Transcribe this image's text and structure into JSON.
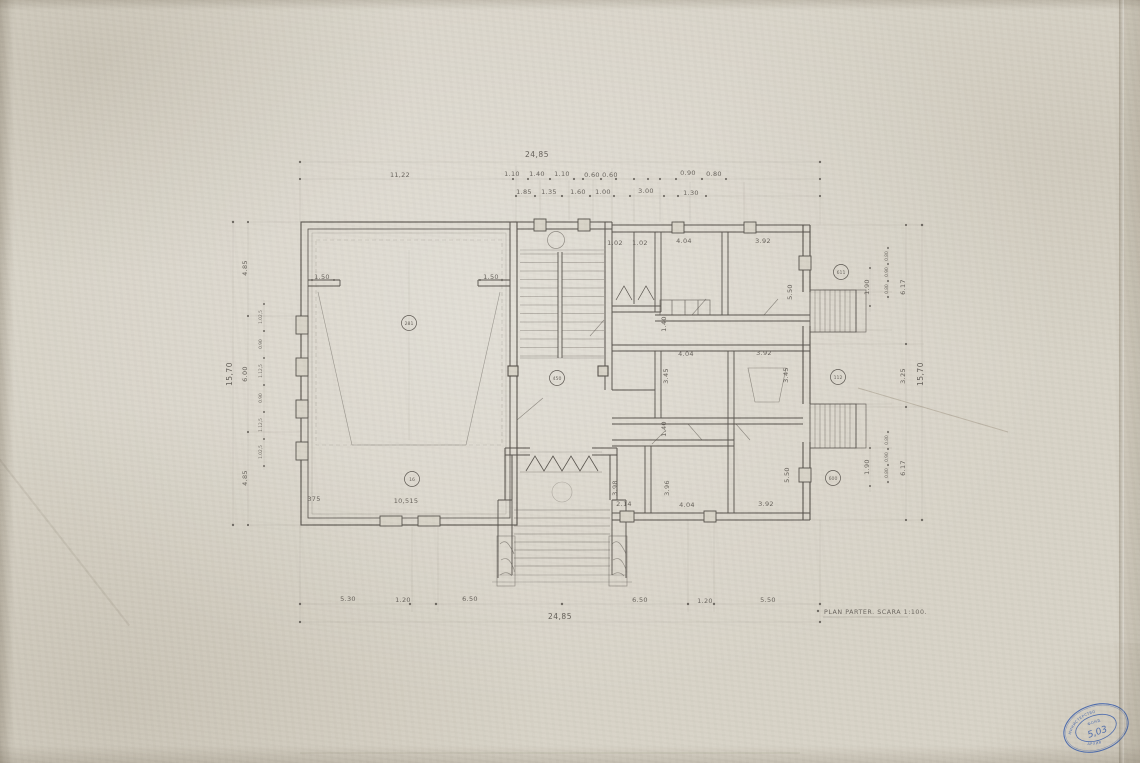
{
  "colors": {
    "paper": "#d8d3c7",
    "ink": "#56514b",
    "stamp": "#3d63b2"
  },
  "caption": "PLAN PARTER. SCARA 1:100.",
  "dims": {
    "top_total": "24,85",
    "top1": [
      "11,22",
      "1.10",
      "1.40",
      "1.10",
      "0.60",
      "0.60",
      "0.90",
      "0.80"
    ],
    "top2": [
      "1.85",
      "1.35",
      "1.60",
      "1.00",
      "3.00",
      "1.30"
    ],
    "bottom": [
      "5.30",
      "1.20",
      "6.50",
      "6.50",
      "1.20",
      "5.50"
    ],
    "bottom_total": "24,85",
    "left_total": "15,70",
    "left_outer": [
      "4.85",
      "6.00",
      "4.85"
    ],
    "left_small": [
      "1.02,5",
      "0.90",
      "1.12,5",
      "0.90",
      "1.12,5",
      "1.02,5"
    ],
    "right_total": "15,70",
    "right_outer": [
      "6.17",
      "3.25",
      "6.17"
    ],
    "right_small_top": [
      "0.80",
      "0.90",
      "0.80"
    ],
    "right_small_bottom": [
      "0.80",
      "0.90",
      "0.80"
    ],
    "right_landing": [
      "1.90",
      "1.90"
    ]
  },
  "rooms": {
    "wc": [
      "1.02",
      "1.02"
    ],
    "top": [
      "4.04",
      "3.92"
    ],
    "top_depth": "5.50",
    "mid": [
      "4.04",
      "3.92"
    ],
    "mid_depth": [
      "3.45",
      "3.45"
    ],
    "corridor": [
      "1.40",
      "1.40"
    ],
    "bottom": [
      "2.14",
      "4.04",
      "3.92"
    ],
    "bottom_depth": [
      "3.98",
      "3.96",
      "5.50"
    ],
    "stage_piers": [
      "1.50",
      "1.50"
    ],
    "hall_bottom": [
      "375",
      "10,515"
    ]
  },
  "tags": {
    "hall": "281",
    "hall2": "16",
    "foyer": "450",
    "right_top": "611",
    "right_mid": "112",
    "right_bottom": "600"
  },
  "stamp": {
    "arc_top": "МИНИСТЕРСТВО",
    "center": "ФОНД",
    "number": "5,03",
    "arc_bottom": "АРХИВ"
  }
}
